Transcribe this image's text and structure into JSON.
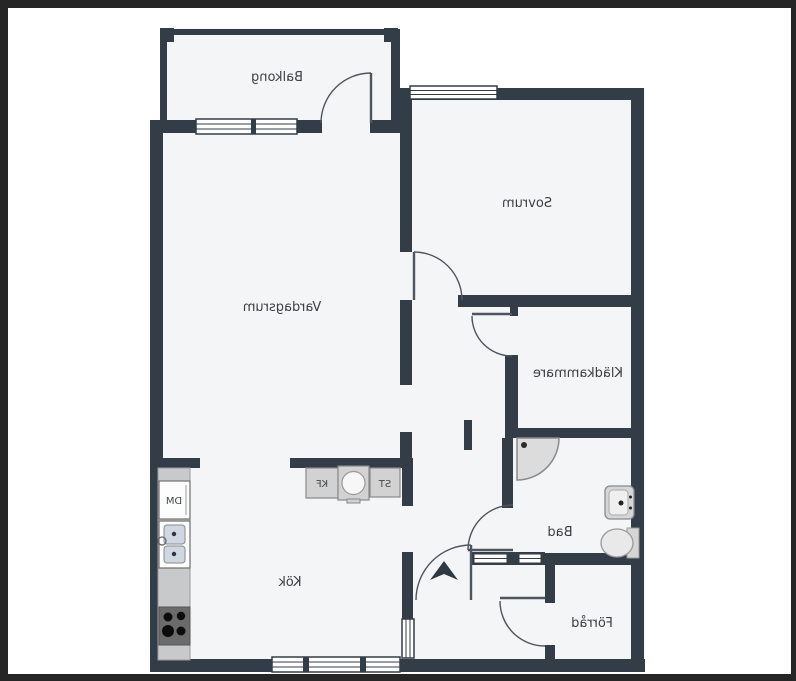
{
  "plan": {
    "type": "apartment-floorplan",
    "text_mirrored": true,
    "rooms": [
      {
        "id": "balcony",
        "label": "Balkong"
      },
      {
        "id": "bedroom",
        "label": "Sovrum"
      },
      {
        "id": "living",
        "label": "Vardagsrum"
      },
      {
        "id": "closet",
        "label": "Klädkammare"
      },
      {
        "id": "bath",
        "label": "Bad"
      },
      {
        "id": "kitchen",
        "label": "Kök"
      },
      {
        "id": "storage",
        "label": "Förråd"
      }
    ],
    "appliances": {
      "dishwasher": {
        "label": "DM"
      },
      "fridge_freezer": {
        "label": "KF"
      },
      "cleaning_cabinet": {
        "label": "ST"
      }
    },
    "fixtures": [
      "shower",
      "sink",
      "toilet",
      "kitchen-sink",
      "stove",
      "washing-machine",
      "counter"
    ],
    "entrance_marker": "up-arrow"
  },
  "colors": {
    "wall": "#333d48",
    "floor": "#f4f5f6",
    "outside": "#ffffff",
    "frame": "#262626",
    "appliance": "#d2d2d2",
    "counter": "#c7c9cb",
    "stove": "#6b6b6b",
    "basin": "#cfd8e2",
    "door_stroke": "#4d555e"
  }
}
